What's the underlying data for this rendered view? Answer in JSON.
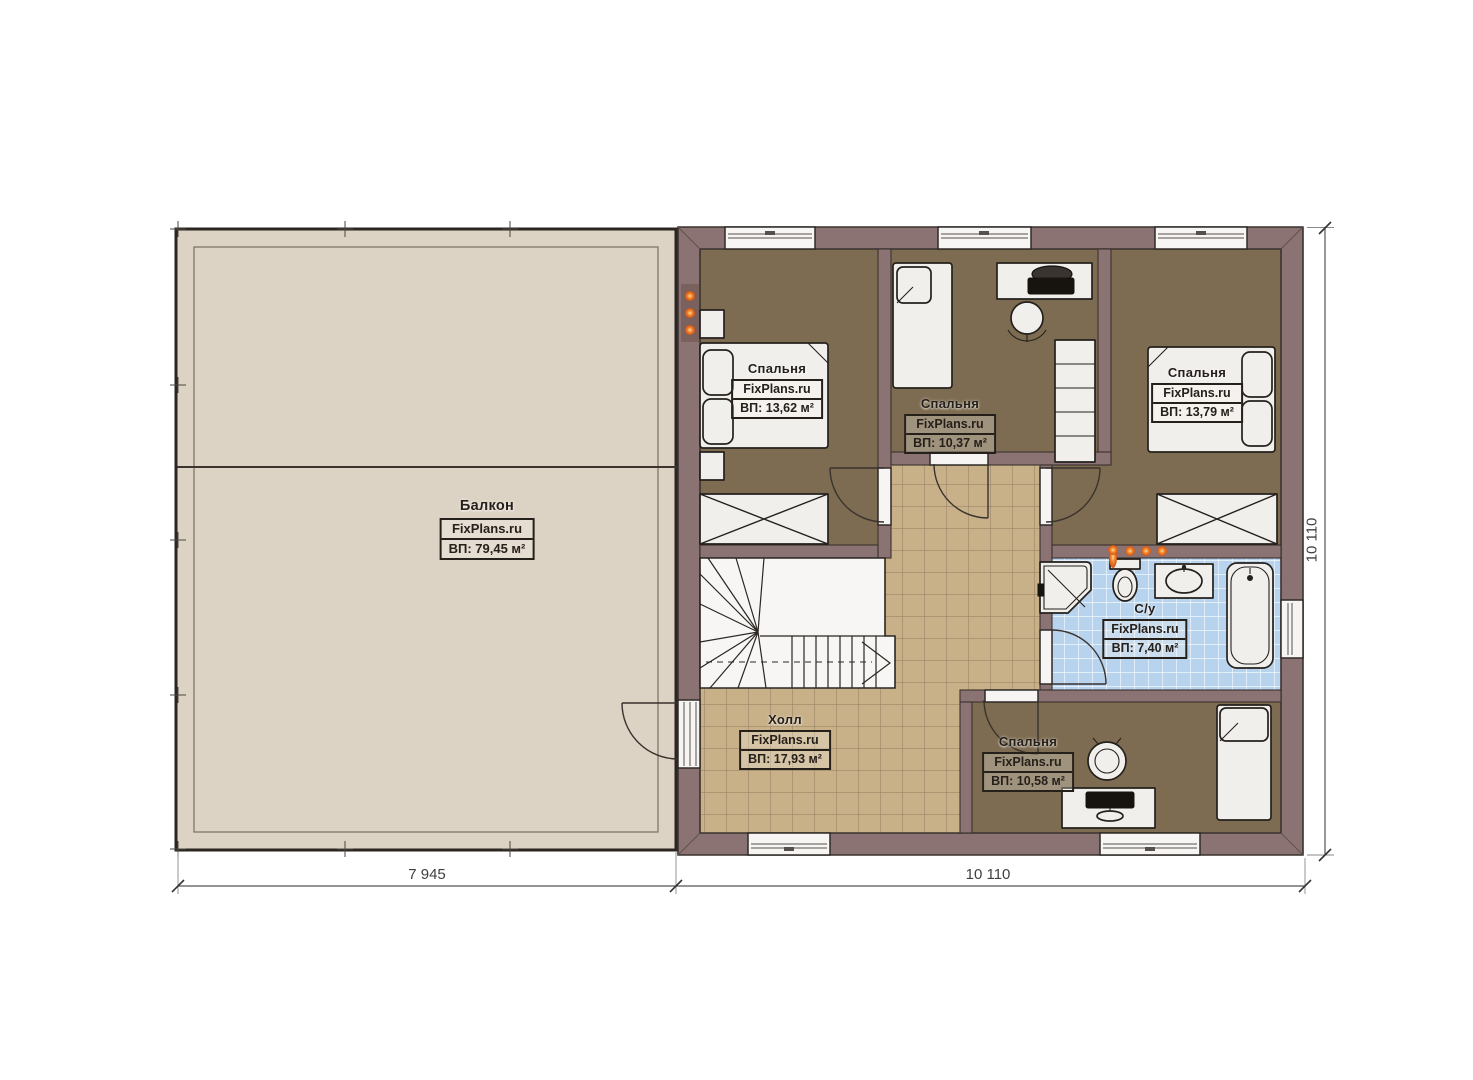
{
  "plan": {
    "watermark": "FixPlans.ru",
    "rooms": [
      {
        "key": "balcony",
        "name": "Балкон",
        "brand": "FixPlans.ru",
        "area": "ВП: 79,45 м²"
      },
      {
        "key": "bedroom-1",
        "name": "Спальня",
        "brand": "FixPlans.ru",
        "area": "ВП: 13,62 м²"
      },
      {
        "key": "bedroom-2",
        "name": "Спальня",
        "brand": "FixPlans.ru",
        "area": "ВП: 10,37 м²"
      },
      {
        "key": "bedroom-3",
        "name": "Спальня",
        "brand": "FixPlans.ru",
        "area": "ВП: 13,79 м²"
      },
      {
        "key": "bathroom",
        "name": "С/у",
        "brand": "FixPlans.ru",
        "area": "ВП: 7,40 м²"
      },
      {
        "key": "hall",
        "name": "Холл",
        "brand": "FixPlans.ru",
        "area": "ВП: 17,93 м²"
      },
      {
        "key": "bedroom-4",
        "name": "Спальня",
        "brand": "FixPlans.ru",
        "area": "ВП: 10,58 м²"
      }
    ],
    "dimensions": {
      "bottom_left": "7 945",
      "bottom_right": "10 110",
      "right_side": "10 110"
    },
    "colors": {
      "wall": "#8b7374",
      "bedroomFloor": "#7d6c51",
      "hallTile": "#c8b089",
      "bathTile": "#b7d3ee",
      "balconyFloor": "#ddd3c4",
      "furniture": "#f1efec",
      "accent": "#e8671c",
      "ink": "#26201a"
    }
  }
}
